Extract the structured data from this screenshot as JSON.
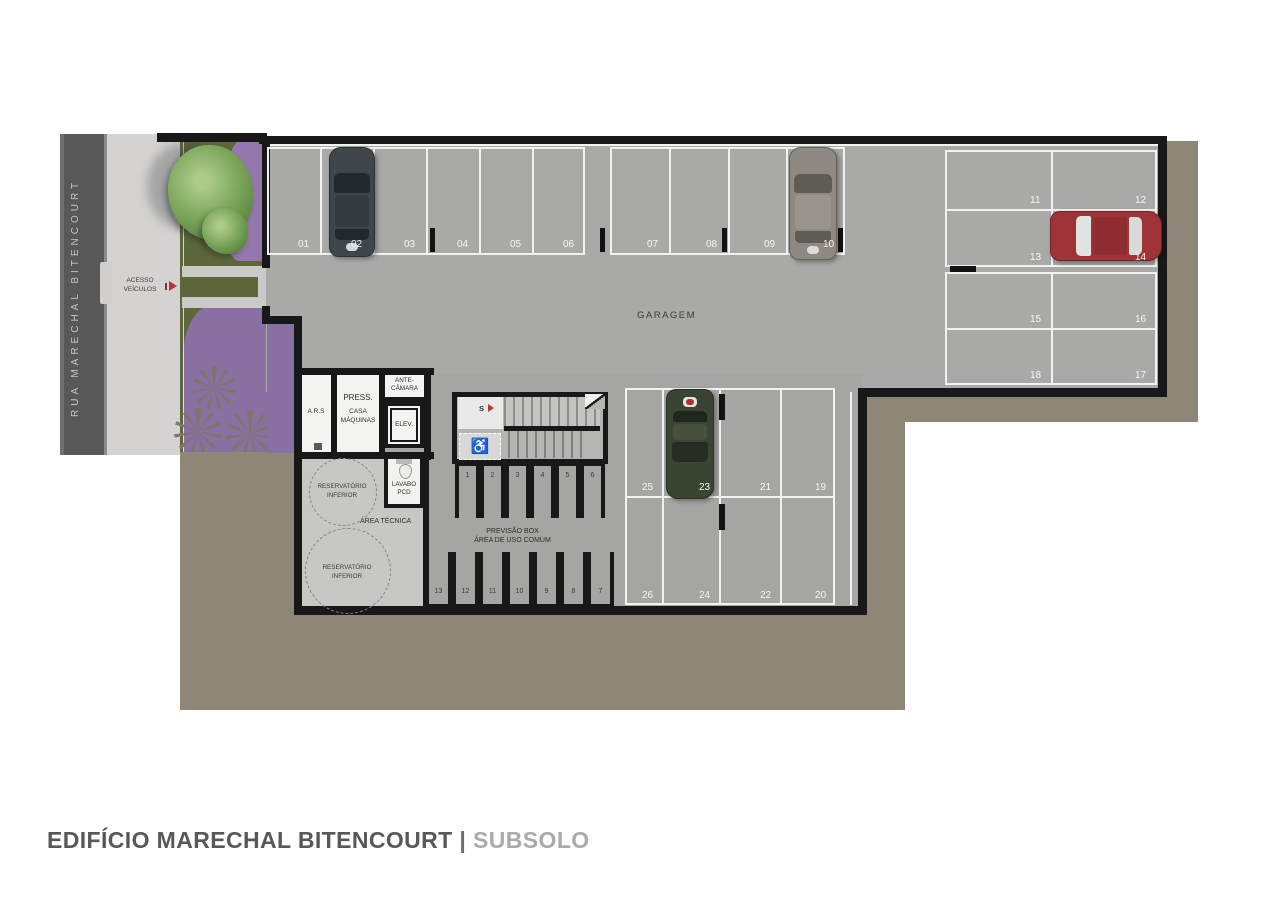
{
  "title": {
    "building": "EDIFÍCIO MARECHAL BITENCOURT",
    "separator": "|",
    "floor": "SUBSOLO"
  },
  "street": {
    "name": "RUA MARECHAL BITENCOURT"
  },
  "access": {
    "line1": "ACESSO",
    "line2": "VEÍCULOS"
  },
  "garage": {
    "label": "GARAGEM"
  },
  "rooms": {
    "ars": "A.R.S",
    "press_line1": "PRESS.",
    "press_line2": "CASA",
    "press_line3": "MÁQUINAS",
    "antecamara_line1": "ANTE-",
    "antecamara_line2": "CÂMARA",
    "elevator": "ELEV.",
    "lavabo_line1": "LAVABO",
    "lavabo_line2": "PCD",
    "area_tecnica": "ÁREA TÉCNICA",
    "reservatorio_line1": "RESERVATÓRIO",
    "reservatorio_line2": "INFERIOR",
    "stairs": "S"
  },
  "boxes": {
    "title_line1": "PREVISÃO BOX",
    "title_line2": "ÁREA DE USO COMUM",
    "top_row": [
      "1",
      "2",
      "3",
      "4",
      "5",
      "6"
    ],
    "bottom_row": [
      "13",
      "12",
      "11",
      "10",
      "9",
      "8",
      "7"
    ]
  },
  "parking": {
    "top_row": [
      "01",
      "02",
      "03",
      "04",
      "05",
      "06",
      "07",
      "08",
      "09",
      "10"
    ],
    "right_block": [
      "11",
      "12",
      "13",
      "14",
      "15",
      "16",
      "18",
      "17"
    ],
    "bottom_block": [
      "25",
      "23",
      "21",
      "19",
      "26",
      "24",
      "22",
      "20"
    ]
  },
  "cars": [
    {
      "space": "02",
      "color": "#3e464b"
    },
    {
      "space": "10",
      "color": "#8e8a83"
    },
    {
      "space": "14",
      "color": "#9e3338"
    },
    {
      "space": "23",
      "color": "#3b4433"
    }
  ],
  "colors": {
    "earth": "#8e8677",
    "floor": "#a9a9a7",
    "accent_red": "#b5373a"
  }
}
